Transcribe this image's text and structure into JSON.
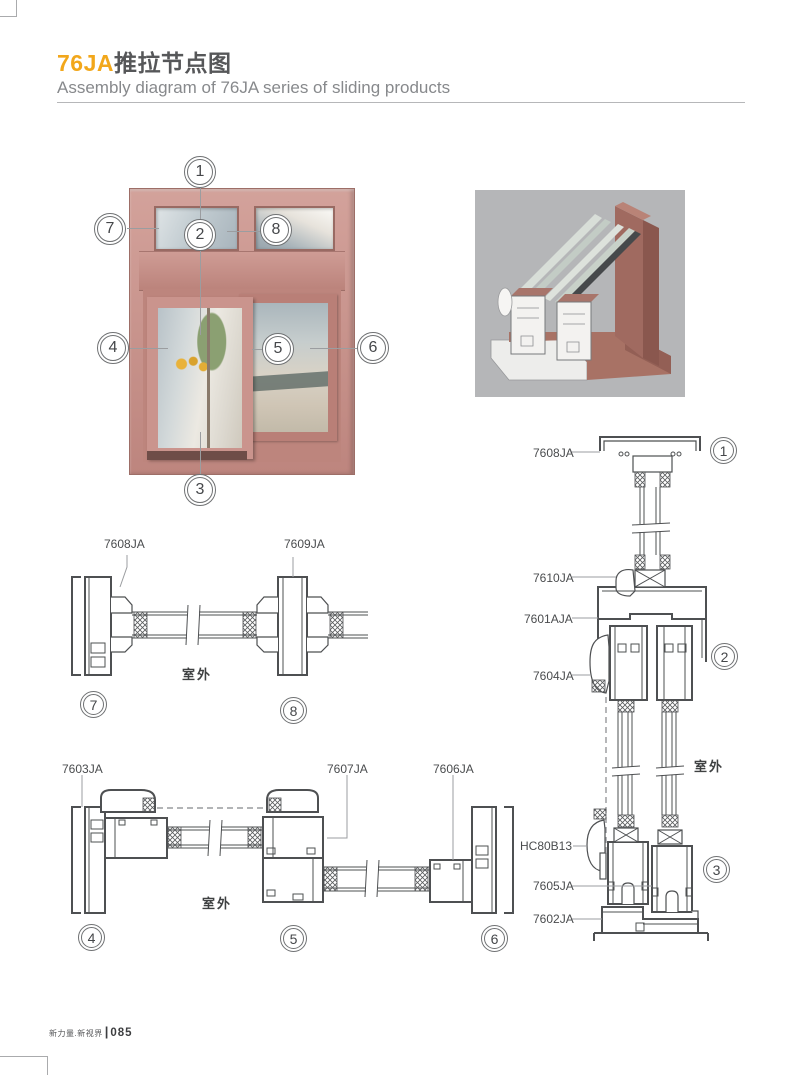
{
  "header": {
    "title_highlight": "76JA",
    "title_rest": "推拉节点图",
    "subtitle": "Assembly diagram of 76JA series of sliding products"
  },
  "callout_numbers": [
    "1",
    "2",
    "3",
    "4",
    "5",
    "6",
    "7",
    "8"
  ],
  "sections": {
    "mid_left": {
      "labels": [
        "7608JA",
        "7609JA"
      ],
      "outdoor_label": "室外"
    },
    "bottom_left": {
      "labels": [
        "7603JA",
        "7607JA",
        "7606JA"
      ],
      "outdoor_label": "室外"
    },
    "right": {
      "labels": [
        "7608JA",
        "7610JA",
        "7601AJA",
        "7604JA",
        "HC80B13",
        "7605JA",
        "7602JA"
      ],
      "outdoor_label": "室外"
    }
  },
  "footer": {
    "brand": "新力量.新视界",
    "divider": "|",
    "page_number": "085"
  },
  "colors": {
    "accent_orange": "#F2A71B",
    "title_dark": "#565759",
    "subtitle_gray": "#87898C",
    "drawing_line": "#4E5052",
    "leader_gray": "#9B9DA0",
    "frame_salmon": "#C58F88",
    "render_background": "#B5B6B8"
  }
}
